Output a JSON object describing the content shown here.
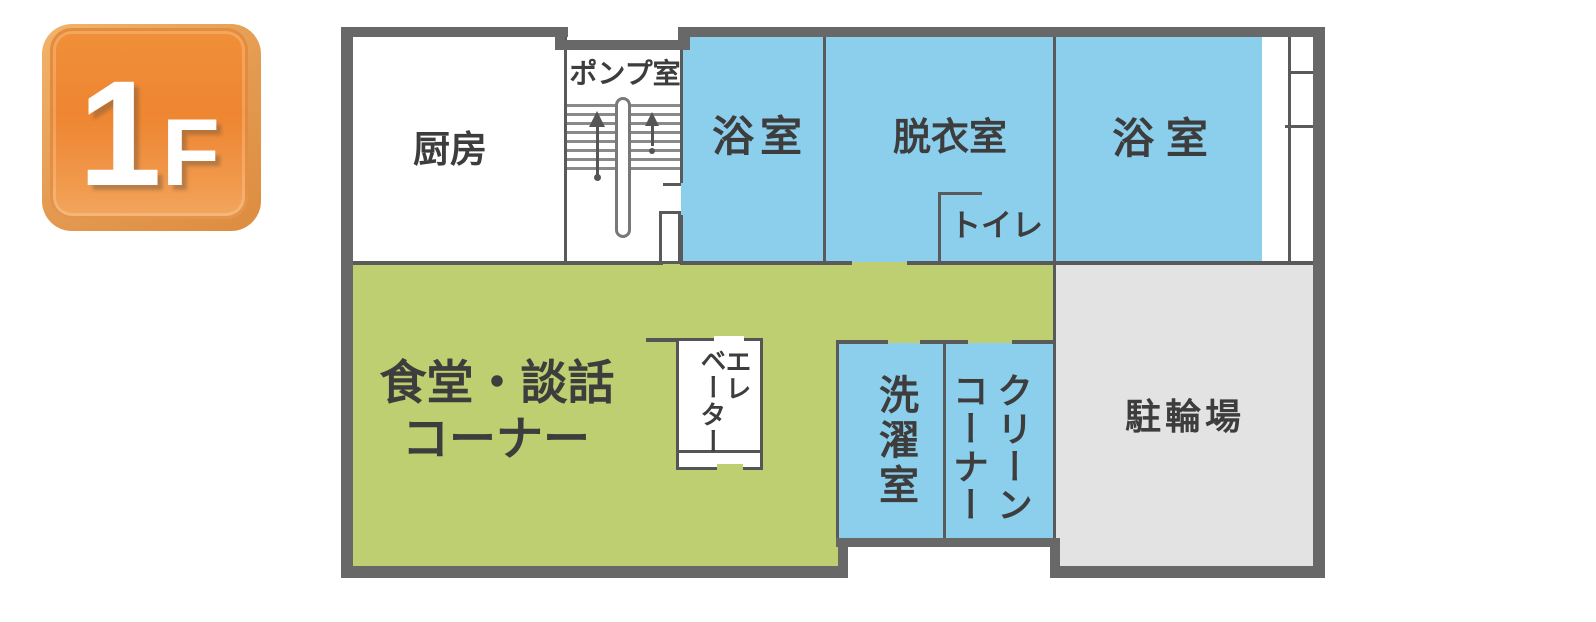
{
  "floor_badge": {
    "number": "1",
    "suffix": "F"
  },
  "colors": {
    "room_blue": "#8CCFEC",
    "room_green": "#BDCF70",
    "room_gray": "#E3E3E3",
    "wall_dark": "#686868",
    "badge_orange": "#EE8531",
    "label_text": "#3D3D3D"
  },
  "rooms": {
    "kitchen": {
      "label": "厨房"
    },
    "pump_room": {
      "label": "ポンプ室"
    },
    "bath_left": {
      "label": "浴室"
    },
    "dressing_room": {
      "label": "脱衣室"
    },
    "toilet": {
      "label": "トイレ"
    },
    "bath_right": {
      "label": "浴 室"
    },
    "dining_lounge": {
      "line1": "食堂・談話",
      "line2": "コーナー"
    },
    "elevator": {
      "col_right": "エレ",
      "col_left": "ベーター"
    },
    "laundry": {
      "label": "洗濯室"
    },
    "clean_corner": {
      "col_right": "クリーン",
      "col_left": "コーナー"
    },
    "bicycle_parking": {
      "label": "駐輪場"
    }
  }
}
